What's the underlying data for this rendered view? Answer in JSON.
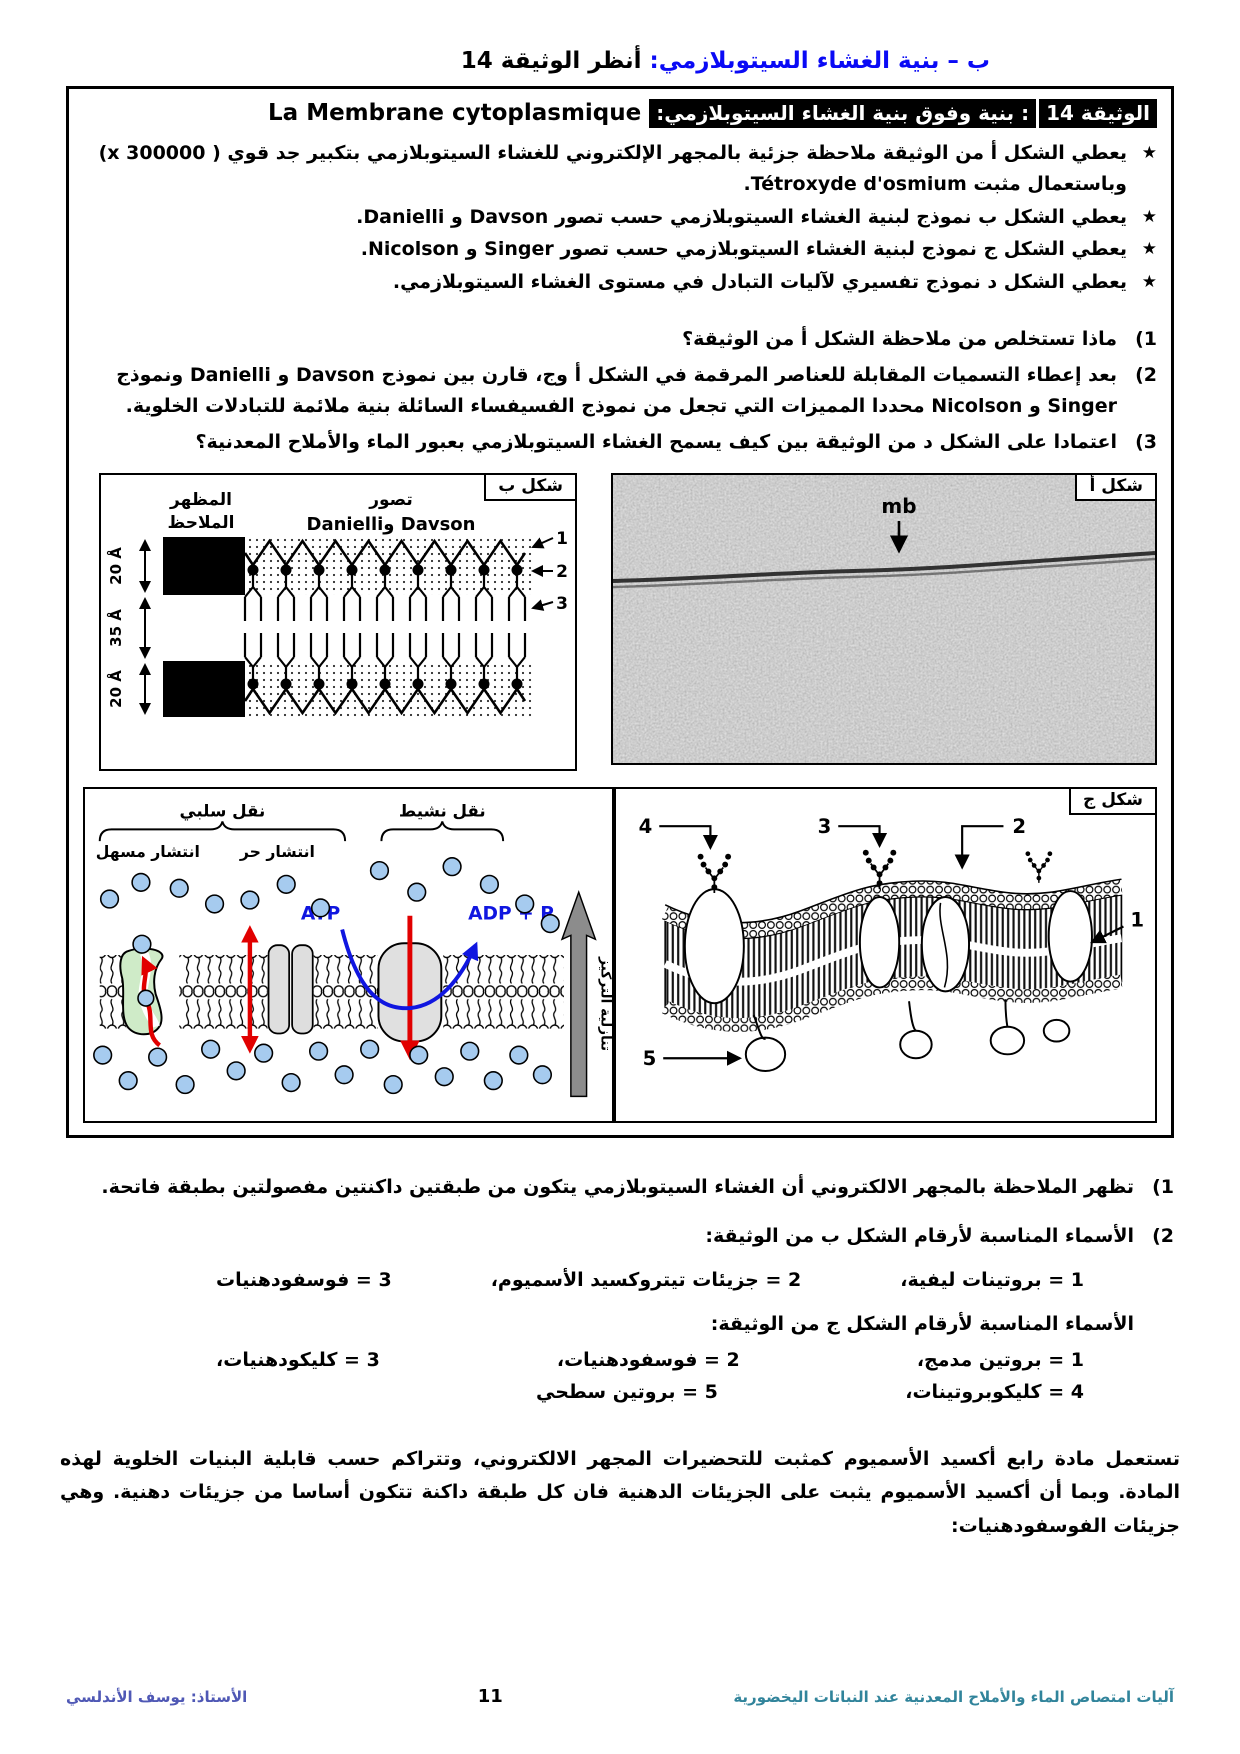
{
  "page": {
    "title_blue": "ب – بنية الغشاء السيتوبلازمي:",
    "title_black": " أنظر الوثيقة 14"
  },
  "doc": {
    "star": "★",
    "tag": "الوثيقة 14",
    "subtitle": ": بنية وفوق بنية الغشاء السيتوبلازمي:",
    "subtitle_fr": "La Membrane cytoplasmique",
    "bullets": [
      "يعطي الشكل أ من الوثيقة ملاحظة جزئية بالمجهر الإلكتروني للغشاء السيتوبلازمي بتكبير جد قوي ( x 300000) وباستعمال مثبت Tétroxyde d'osmium.",
      "يعطي الشكل ب نموذج لبنية الغشاء السيتوبلازمي حسب تصور Davson و Danielli.",
      "يعطي الشكل ج نموذج لبنية الغشاء السيتوبلازمي حسب تصور Singer و Nicolson.",
      "يعطي الشكل د نموذج تفسيري لآليات التبادل في مستوى الغشاء السيتوبلازمي."
    ],
    "questions": [
      {
        "num": "1)",
        "text": "ماذا تستخلص من ملاحظة الشكل أ من الوثيقة؟"
      },
      {
        "num": "2)",
        "text": "بعد إعطاء التسميات المقابلة للعناصر المرقمة في الشكل أ وج، قارن بين نموذج Davson و Danielli ونموذج Singer و Nicolson محددا المميزات التي تجعل من نموذج الفسيفساء السائلة بنية ملائمة للتبادلات الخلوية."
      },
      {
        "num": "3)",
        "text": "اعتمادا على الشكل د من الوثيقة بين كيف يسمح الغشاء السيتوبلازمي بعبور الماء والأملاح المعدنية؟"
      }
    ]
  },
  "fig_b": {
    "label": "شكل ب",
    "col_observed_1": "المظهر",
    "col_observed_2": "الملاحظ",
    "col_model_1": "تصور",
    "col_model_2": "Davson وDanielli",
    "dim_top": "20 Å",
    "dim_mid": "35 Å",
    "dim_bottom": "20 Å",
    "pointers": [
      "1",
      "2",
      "3"
    ]
  },
  "fig_a": {
    "label": "شكل أ",
    "mb_label": "mb"
  },
  "fig_d": {
    "passive_label": "نقل سلبي",
    "active_label": "نقل نشيط",
    "facilitated_label": "انتشار مسهل",
    "free_label": "انتشار حر",
    "atp": "ATP",
    "adp": "ADP + P",
    "gradient_label": "تنازلية التركيز"
  },
  "fig_c": {
    "label": "شكل ج",
    "pointers": [
      "1",
      "2",
      "3",
      "4",
      "5"
    ]
  },
  "answers": {
    "a1_num": "1)",
    "a1": "تظهر الملاحظة بالمجهر الالكتروني أن الغشاء السيتوبلازمي يتكون من طبقتين داكنتين مفصولتين بطبقة فاتحة.",
    "a2_num": "2)",
    "a2_intro_b": "الأسماء المناسبة لأرقام الشكل ب من الوثيقة:",
    "b_items": [
      "1 = بروتينات ليفية،",
      "2 = جزيئات تيتروكسيد الأسميوم،",
      "3 = فوسفودهنيات"
    ],
    "a2_intro_c": "الأسماء المناسبة لأرقام الشكل ج من الوثيقة:",
    "c_row1": [
      "1 = بروتين مدمج،",
      "2 = فوسفودهنيات،",
      "3 = كليكودهنيات،"
    ],
    "c_row2": [
      "4 = كليكوبروتينات،",
      "5  = بروتين سطحي"
    ],
    "paragraph": "تستعمل مادة رابع أكسيد الأسميوم كمثبت للتحضيرات المجهر الالكتروني، وتتراكم حسب قابلية البنيات الخلوية لهذه المادة. وبما أن أكسيد الأسميوم يثبت على الجزيئات الدهنية فان كل طبقة داكنة تتكون أساسا من جزيئات دهنية. وهي جزيئات الفوسفودهنيات:"
  },
  "footer": {
    "right": "آليات امتصاص الماء والأملاح المعدنية عند النباتات اليخضورية",
    "page": "11",
    "left": "الأستاذ: يوسف الأندلسي"
  },
  "colors": {
    "title_blue": "#0a0af5",
    "atp_blue": "#1016e0",
    "arrow_red": "#e10000",
    "molecule_blue": "#a6cbef",
    "channel_green": "#cfebc8",
    "protein_gray": "#dedede",
    "footer_right": "#31849b",
    "footer_left": "#4f58b5"
  }
}
